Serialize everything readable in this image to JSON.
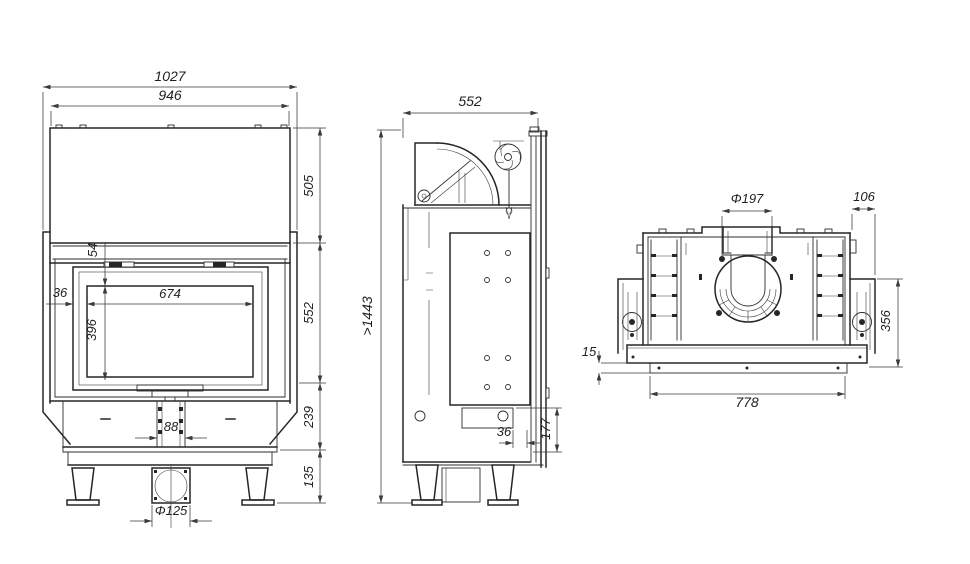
{
  "title": "fireplace-insert-technical-drawing",
  "colors": {
    "background": "#ffffff",
    "line": "#262626",
    "dim_line": "#3a3a3a"
  },
  "views": {
    "front": {
      "label": "front-view",
      "dims": {
        "overall_width": "1027",
        "casing_width": "946",
        "hood_height": "505",
        "door_top_to_glass": "54",
        "frame_margin": "36",
        "glass_width": "674",
        "glass_height": "396",
        "firebox_height": "552",
        "base_height": "239",
        "legs_height": "135",
        "air_inlet_width": "88",
        "air_inlet_diameter": "Φ125"
      }
    },
    "side": {
      "label": "side-view",
      "dims": {
        "depth": "552",
        "min_installation_height": ">1443",
        "rear_gap": "36",
        "rear_duct_height": "177"
      }
    },
    "top": {
      "label": "top-view",
      "dims": {
        "flue_diameter": "Φ197",
        "side_bracket_offset": "106",
        "top_depth": "356",
        "front_bar_gap": "15",
        "base_width": "778"
      }
    }
  }
}
